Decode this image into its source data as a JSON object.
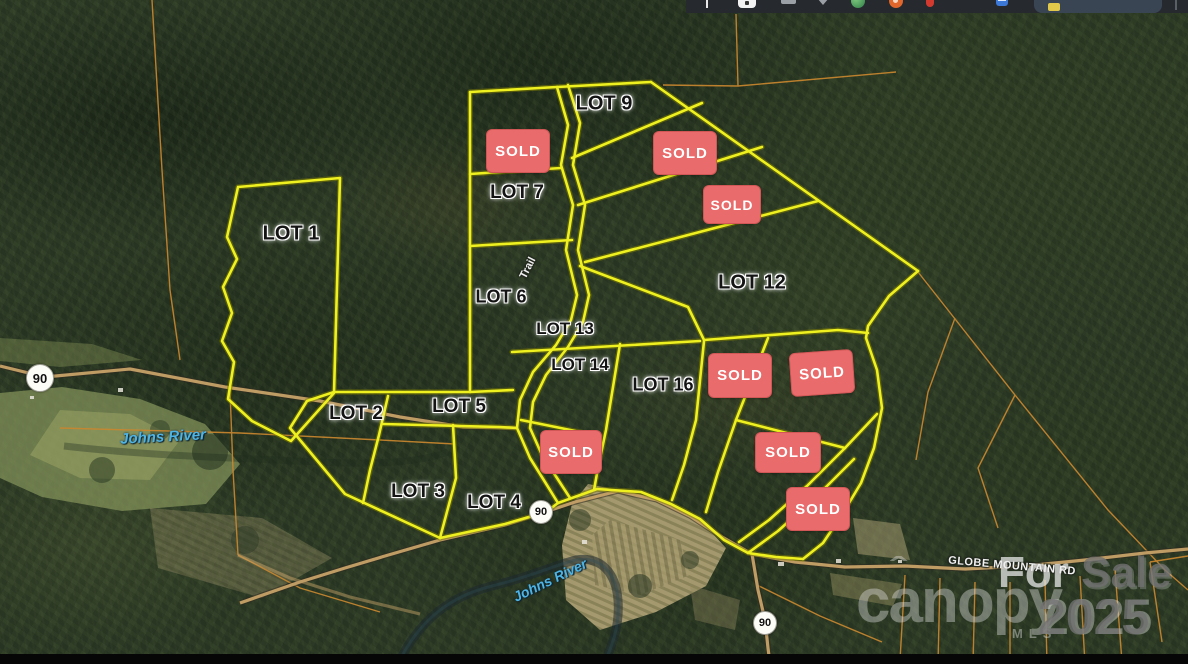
{
  "browser_bar": {
    "icons": [
      {
        "name": "text-cursor-icon"
      },
      {
        "name": "extension-icon"
      },
      {
        "name": "cast-icon"
      },
      {
        "name": "chevron-down-icon"
      },
      {
        "name": "globe-icon"
      },
      {
        "name": "reddit-icon"
      },
      {
        "name": "pin-icon"
      },
      {
        "name": "bookmarks-icon"
      },
      {
        "name": "active-tab-folder-icon"
      }
    ]
  },
  "map": {
    "lot_labels": [
      {
        "label": "LOT 1"
      },
      {
        "label": "LOT 2"
      },
      {
        "label": "LOT 3"
      },
      {
        "label": "LOT 4"
      },
      {
        "label": "LOT 5"
      },
      {
        "label": "LOT 6"
      },
      {
        "label": "LOT 7"
      },
      {
        "label": "LOT 9"
      },
      {
        "label": "LOT 12"
      },
      {
        "label": "LOT 13"
      },
      {
        "label": "LOT 14"
      },
      {
        "label": "LOT 16"
      }
    ],
    "sold_label": "SOLD",
    "route_shield": "90",
    "road_label": "GLOBE MOUNTAIN RD",
    "river_label": "Johns River",
    "trail_label": "Trail",
    "watermark": {
      "prefix": "For",
      "word": "Sale",
      "year": "2025",
      "brand": "canopy",
      "brand_sub": "MLS"
    },
    "colors": {
      "boundary_yellow": "#eef01f",
      "parcel_orange": "#c9872f",
      "sold_bg": "#e96b6b",
      "road_tan": "#c6a268",
      "river_text": "#4db4e4"
    }
  }
}
